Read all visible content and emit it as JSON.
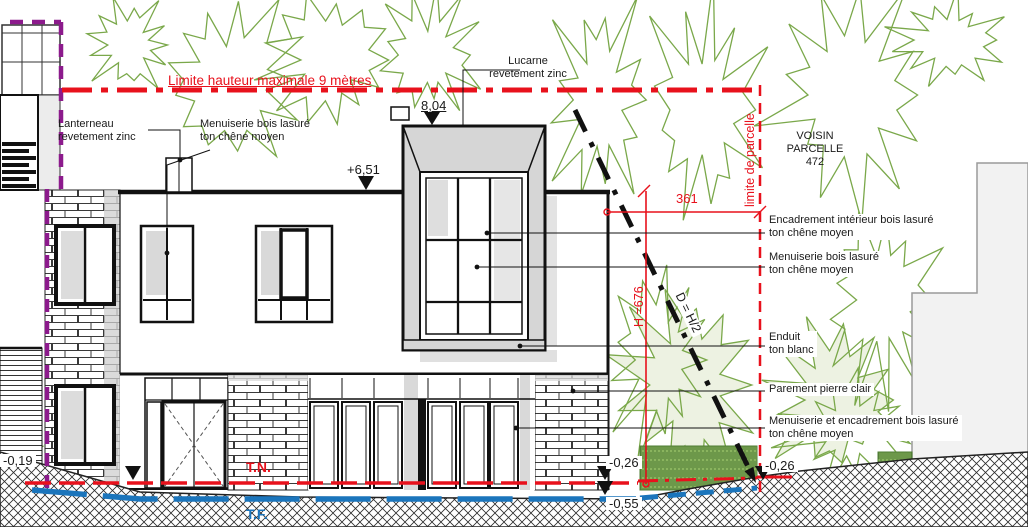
{
  "annotations": {
    "limite_hauteur": "Limite hauteur maximale 9 mètres",
    "lucarne_line1": "Lucarne",
    "lucarne_line2": "revetement zinc",
    "lanterneau_line1": "Lanterneau",
    "lanterneau_line2": "revetement zinc",
    "menuiserie_haut_line1": "Menuiserie bois lasuré",
    "menuiserie_haut_line2": "ton chêne moyen",
    "voisin_line1": "VOISIN",
    "voisin_line2": "PARCELLE",
    "voisin_line3": "472",
    "limite_parcelle": "limite de parcelle",
    "encadrement_line1": "Encadrement intérieur bois lasuré",
    "encadrement_line2": "ton chêne moyen",
    "menuiserie_etage_line1": "Menuiserie bois lasuré",
    "menuiserie_etage_line2": "ton chêne moyen",
    "enduit_line1": "Enduit",
    "enduit_line2": "ton blanc",
    "parement": "Parement pierre clair",
    "menuiserie_rdc_line1": "Menuiserie et encadrement bois lasuré",
    "menuiserie_rdc_line2": "ton chêne moyen"
  },
  "levels": {
    "fait_lucarne": "8,04",
    "acrotere": "+6,51",
    "tn_gauche": "-0,19",
    "tn_droit": "-0,26",
    "tf_bas": "-0,55",
    "tn_limite": "-0,26",
    "terrain_naturel": "T.N.",
    "terrain_fini": "T.F."
  },
  "dimensions": {
    "distance_parcelle": "361",
    "hauteur": "H =676",
    "regle_prospect": "D = H/2"
  },
  "colors": {
    "reglementaire_red": "#e8111c",
    "parcelle_purple": "#8c1a8c",
    "tf_blue": "#1b75bc",
    "vegetation_green": "#7aa84a"
  }
}
